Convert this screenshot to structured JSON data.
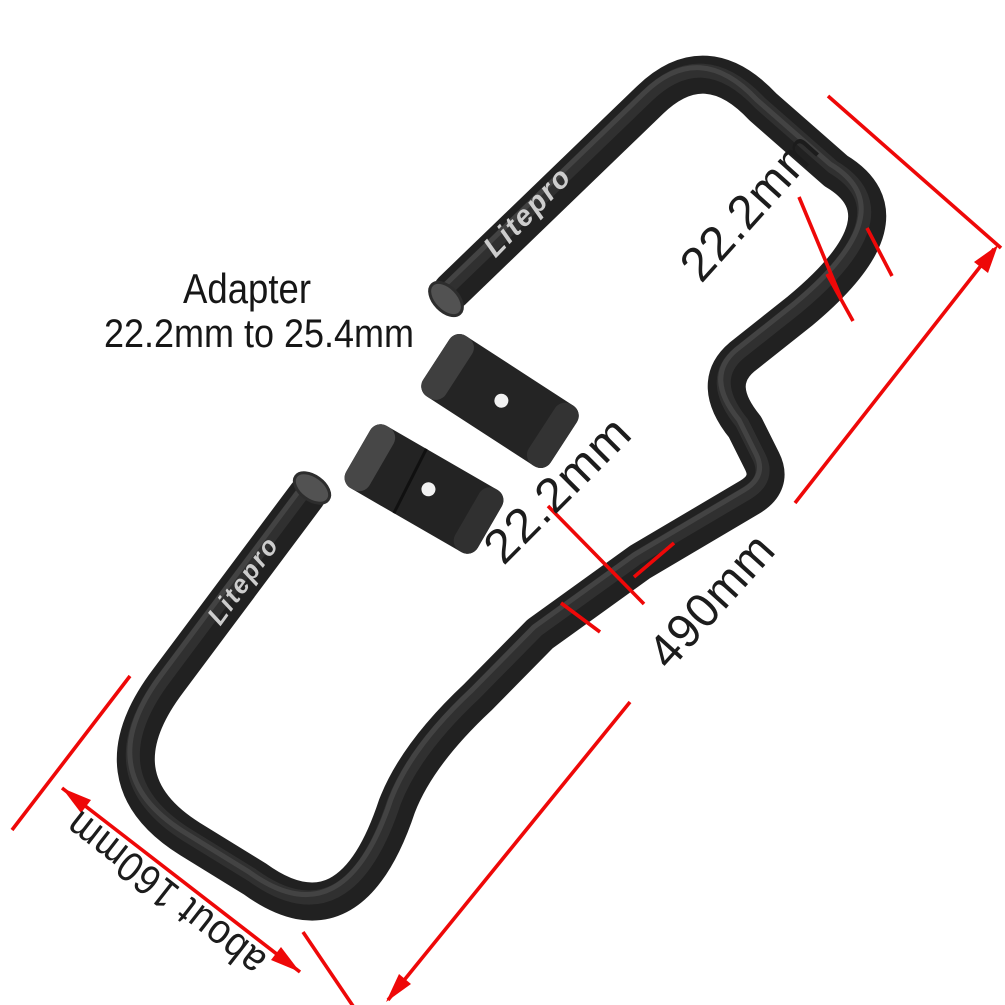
{
  "product": {
    "brand": "Litepro",
    "note": {
      "line1": "Adapter",
      "line2": "22.2mm to 25.4mm"
    },
    "dimensions": {
      "top_grip_diameter": "22.2mm",
      "mid_tube_diameter": "22.2mm",
      "overall_length": "490mm",
      "grip_section_length": "about 160mm"
    },
    "colors": {
      "dimension_red": "#ee0808",
      "tube_black": "#212121",
      "tube_highlight": "#4a4a4a",
      "endcap_gray": "#525252",
      "label_black": "#1c1c1c",
      "logo_gray": "#cdcdcd",
      "background": "#ffffff"
    }
  }
}
